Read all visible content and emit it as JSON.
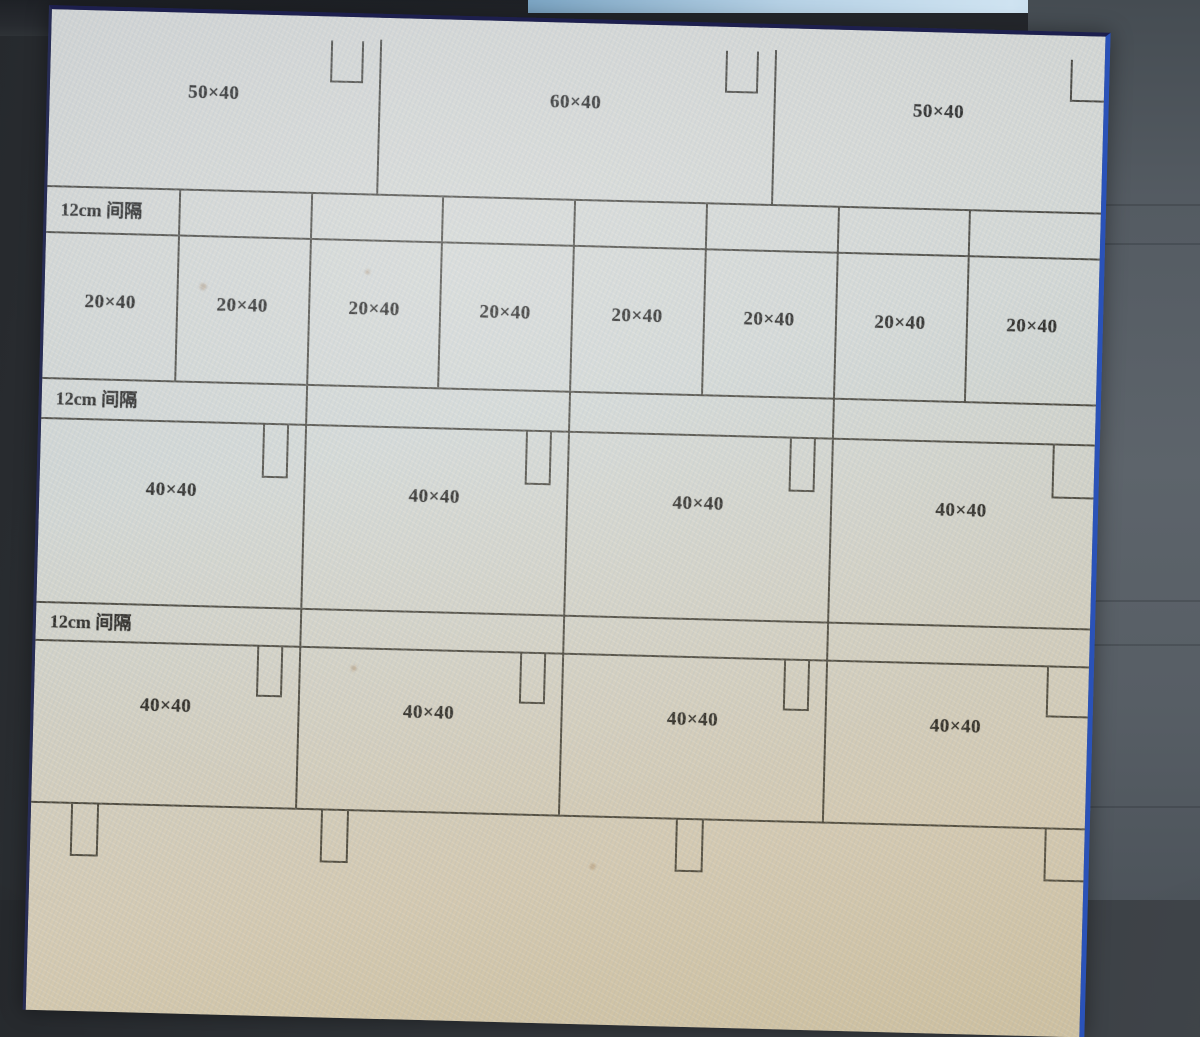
{
  "photo": {
    "surround_color": "#2e3236",
    "side_panel_color": "#5a6167",
    "top_strip_color": "#24272c",
    "toolbar_sliver_color": "#b6d1e5",
    "toolbar_accent_color": "#3b66c6",
    "page_color": "#d7d6ce",
    "page_border_top_color": "#1d1f4e",
    "page_border_right_color": "#2a52b8",
    "line_color": "#45433b",
    "text_color": "#23221f"
  },
  "diagram": {
    "rows": [
      {
        "id": "top-row",
        "kind": "panels",
        "cells": [
          "50×40",
          "60×40",
          "50×40"
        ]
      },
      {
        "id": "spacer-1",
        "kind": "spacer",
        "label": "12cm 间隔"
      },
      {
        "id": "row-20",
        "kind": "panels",
        "cells": [
          "20×40",
          "20×40",
          "20×40",
          "20×40",
          "20×40",
          "20×40",
          "20×40",
          "20×40"
        ]
      },
      {
        "id": "spacer-2",
        "kind": "spacer",
        "label": "12cm 间隔"
      },
      {
        "id": "row-40-upper",
        "kind": "panels",
        "cells": [
          "40×40",
          "40×40",
          "40×40",
          "40×40"
        ]
      },
      {
        "id": "spacer-3",
        "kind": "spacer",
        "label": "12cm 间隔"
      },
      {
        "id": "row-40-lower",
        "kind": "panels",
        "cells": [
          "40×40",
          "40×40",
          "40×40",
          "40×40"
        ]
      }
    ]
  }
}
